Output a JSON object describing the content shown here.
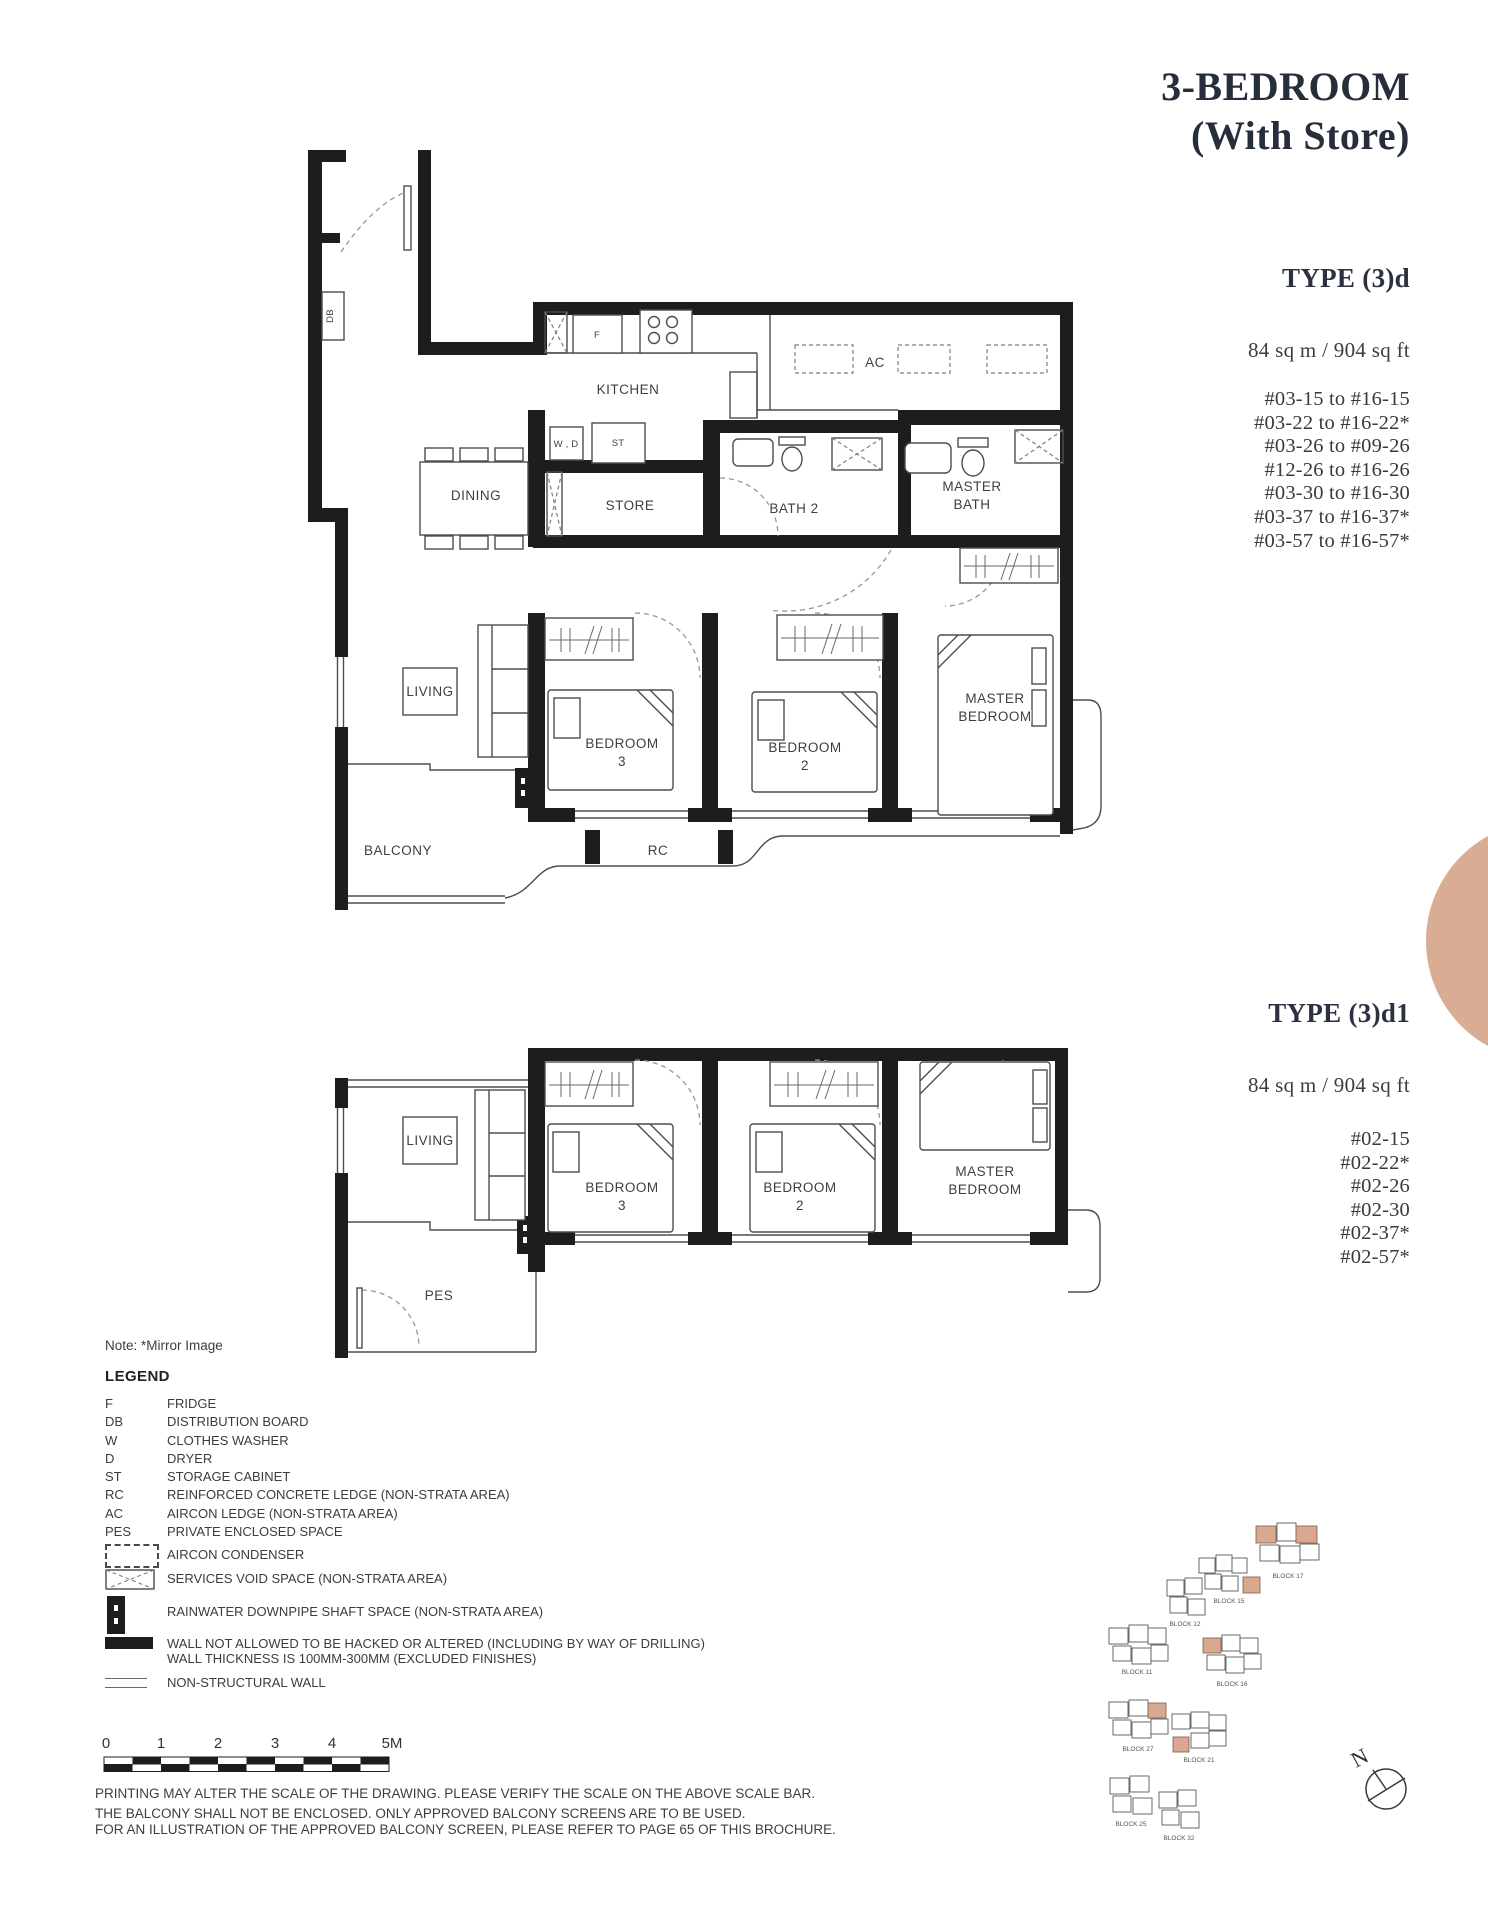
{
  "header": {
    "title_line1": "3-BEDROOM",
    "title_line2": "(With Store)"
  },
  "type_d": {
    "name": "TYPE (3)d",
    "area": "84 sq m / 904 sq ft",
    "units": [
      "#03-15 to #16-15",
      "#03-22 to #16-22*",
      "#03-26 to #09-26",
      "#12-26 to #16-26",
      "#03-30 to #16-30",
      "#03-37 to #16-37*",
      "#03-57 to #16-57*"
    ]
  },
  "type_d1": {
    "name": "TYPE (3)d1",
    "area": "84 sq m / 904 sq ft",
    "units": [
      "#02-15",
      "#02-22*",
      "#02-26",
      "#02-30",
      "#02-37*",
      "#02-57*"
    ]
  },
  "plan_top": {
    "labels": {
      "kitchen": "KITCHEN",
      "dining": "DINING",
      "store": "STORE",
      "bath2": "BATH 2",
      "master_bath_1": "MASTER",
      "master_bath_2": "BATH",
      "living": "LIVING",
      "bedroom3_1": "BEDROOM",
      "bedroom3_2": "3",
      "bedroom2_1": "BEDROOM",
      "bedroom2_2": "2",
      "master_bed_1": "MASTER",
      "master_bed_2": "BEDROOM",
      "balcony": "BALCONY",
      "rc": "RC",
      "ac": "AC",
      "fridge": "F",
      "washer_dryer": "W , D",
      "storage": "ST",
      "db": "DB"
    }
  },
  "plan_bottom": {
    "labels": {
      "living": "LIVING",
      "pes": "PES",
      "bedroom3_1": "BEDROOM",
      "bedroom3_2": "3",
      "bedroom2_1": "BEDROOM",
      "bedroom2_2": "2",
      "master_bed_1": "MASTER",
      "master_bed_2": "BEDROOM"
    }
  },
  "note_mirror": "Note: *Mirror Image",
  "legend": {
    "heading": "LEGEND",
    "abbr_rows": [
      {
        "abbr": "F",
        "desc": "FRIDGE"
      },
      {
        "abbr": "DB",
        "desc": "DISTRIBUTION BOARD"
      },
      {
        "abbr": "W",
        "desc": "CLOTHES WASHER"
      },
      {
        "abbr": "D",
        "desc": "DRYER"
      },
      {
        "abbr": "ST",
        "desc": "STORAGE CABINET"
      },
      {
        "abbr": "RC",
        "desc": "REINFORCED CONCRETE LEDGE (NON-STRATA AREA)"
      },
      {
        "abbr": "AC",
        "desc": "AIRCON LEDGE (NON-STRATA AREA)"
      },
      {
        "abbr": "PES",
        "desc": "PRIVATE ENCLOSED SPACE"
      }
    ],
    "icon_rows": [
      {
        "desc": "AIRCON CONDENSER"
      },
      {
        "desc": "SERVICES VOID SPACE (NON-STRATA AREA)"
      },
      {
        "desc": "RAINWATER DOWNPIPE SHAFT SPACE (NON-STRATA AREA)"
      },
      {
        "desc": "WALL NOT ALLOWED TO BE HACKED OR ALTERED (INCLUDING BY WAY OF DRILLING)",
        "desc2": "WALL THICKNESS IS 100MM-300MM (EXCLUDED FINISHES)"
      },
      {
        "desc": "NON-STRUCTURAL WALL"
      }
    ]
  },
  "scale_bar": {
    "ticks": [
      "0",
      "1",
      "2",
      "3",
      "4",
      "5M"
    ]
  },
  "footnotes": [
    "PRINTING MAY ALTER THE SCALE OF THE DRAWING. PLEASE VERIFY THE SCALE ON THE ABOVE SCALE BAR.",
    "THE BALCONY SHALL NOT BE ENCLOSED. ONLY APPROVED BALCONY SCREENS ARE TO BE USED.",
    "FOR AN ILLUSTRATION OF THE APPROVED BALCONY SCREEN, PLEASE REFER TO PAGE 65 OF THIS BROCHURE."
  ],
  "site_plan": {
    "north": "N",
    "blocks": [
      "BLOCK 17",
      "BLOCK 15",
      "BLOCK 12",
      "BLOCK 11",
      "BLOCK 16",
      "BLOCK 27",
      "BLOCK 21",
      "BLOCK 25",
      "BLOCK 32"
    ]
  },
  "colors": {
    "accent_peach": "#d8ad93",
    "ink": "#1d1d1b",
    "title": "#262d3b"
  }
}
